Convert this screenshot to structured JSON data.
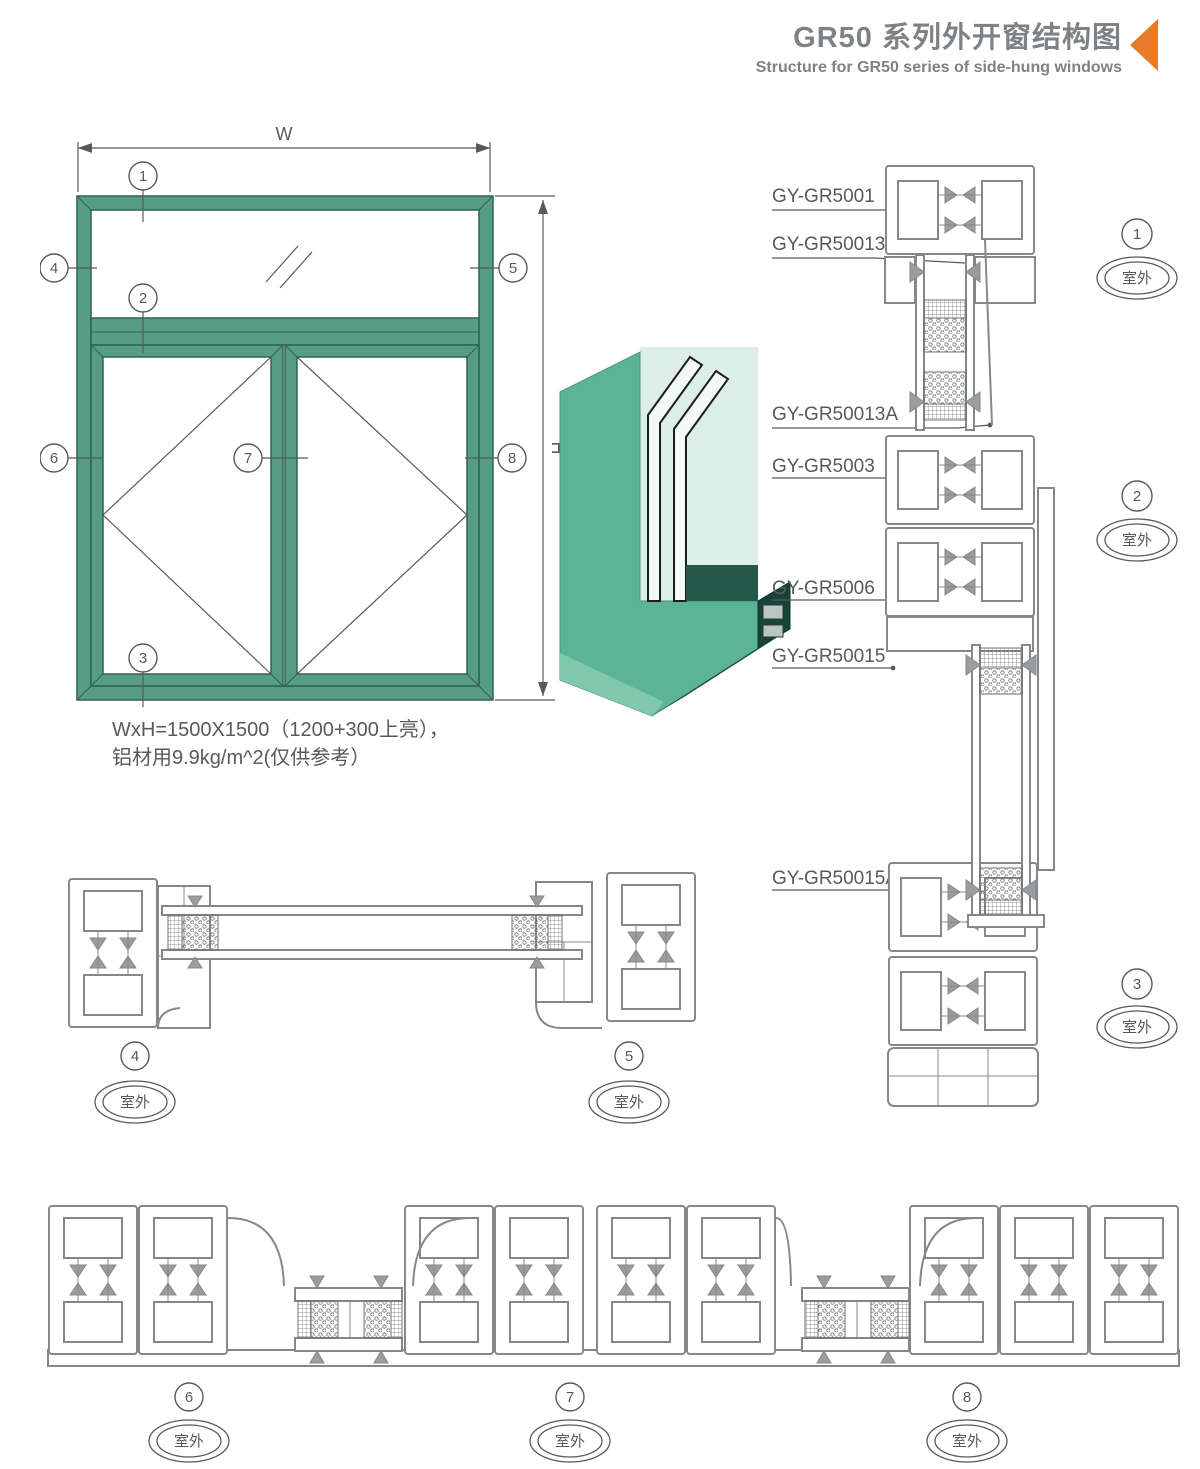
{
  "header": {
    "title": "GR50 系列外开窗结构图",
    "subtitle": "Structure for GR50 series of side-hung windows"
  },
  "spec": {
    "line1": "WxH=1500X1500（1200+300上亮），",
    "line2": "铝材用9.9kg/m^2(仅供参考）"
  },
  "dims": {
    "w": "W",
    "h": "H"
  },
  "outdoor": "室外",
  "callouts": {
    "c1": "1",
    "c2": "2",
    "c3": "3",
    "c4": "4",
    "c5": "5",
    "c6": "6",
    "c7": "7",
    "c8": "8"
  },
  "profiles": {
    "p1": "GY-GR5001",
    "p2": "GY-GR50013",
    "p3": "GY-GR50013A",
    "p4": "GY-GR5003",
    "p5": "GY-GR5006",
    "p6": "GY-GR50015",
    "p7": "GY-GR50015A"
  },
  "colors": {
    "accent": "#e87b27",
    "frame_green": "#579c85",
    "render_green": "#5cb496",
    "line_gray": "#85888b",
    "text_gray": "#58595b",
    "title_gray": "#7f8285"
  }
}
